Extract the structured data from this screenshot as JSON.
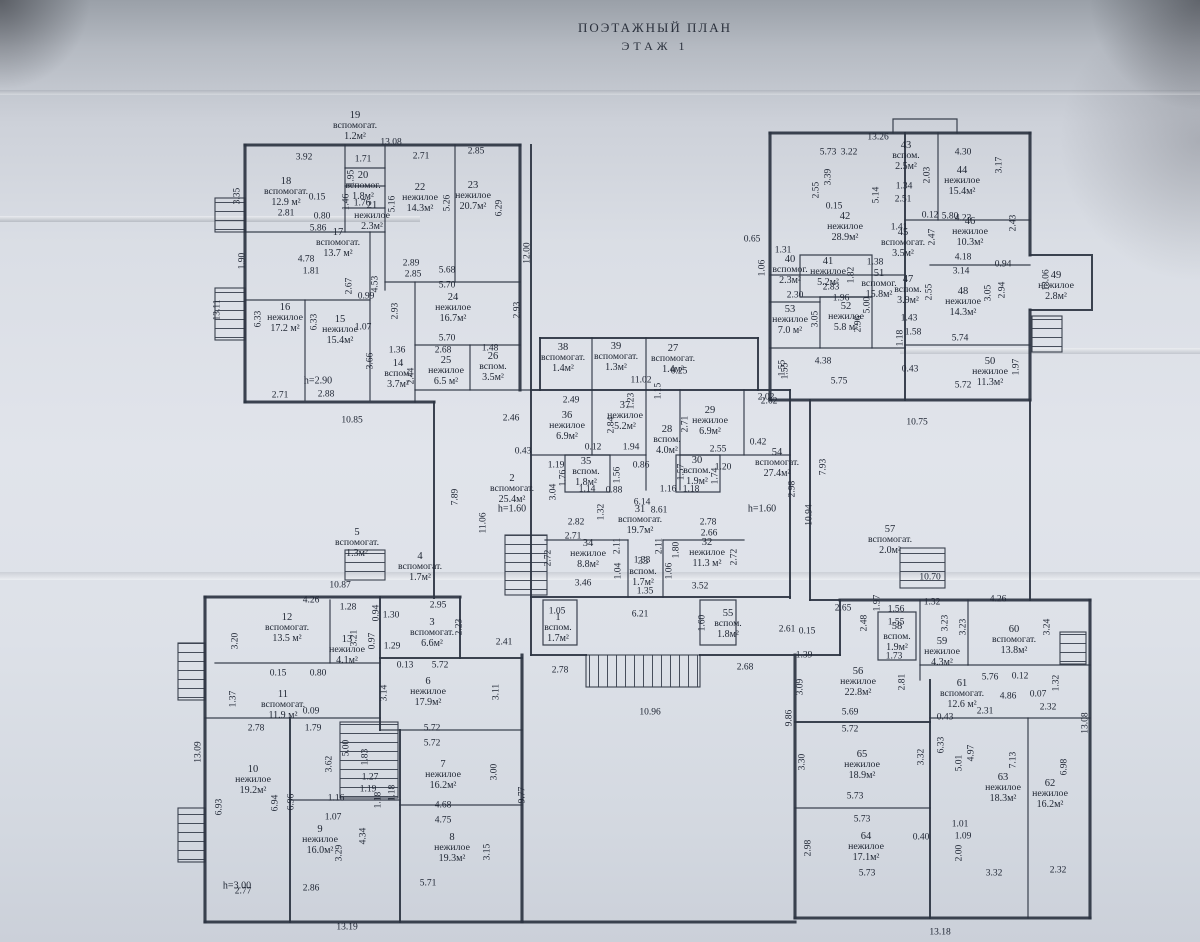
{
  "title": {
    "line1": "ПОЭТАЖНЫЙ ПЛАН",
    "line2": "ЭТАЖ   1"
  },
  "colors": {
    "ink": "#2d3442",
    "paper": "#dde1e8"
  },
  "rooms": [
    [
      "1",
      "вспом.",
      "1.7м²",
      558,
      628
    ],
    [
      "2",
      "вспомогат.",
      "25.4м²",
      512,
      489
    ],
    [
      "3",
      "вспомогат.",
      "6.6м²",
      432,
      633
    ],
    [
      "4",
      "вспомогат.",
      "1.7м²",
      420,
      567
    ],
    [
      "5",
      "вспомогат.",
      "1.3м²",
      357,
      543
    ],
    [
      "6",
      "нежилое",
      "17.9м²",
      428,
      692
    ],
    [
      "7",
      "нежилое",
      "16.2м²",
      443,
      775
    ],
    [
      "8",
      "нежилое",
      "19.3м²",
      452,
      848
    ],
    [
      "9",
      "нежилое",
      "16.0м²",
      320,
      840
    ],
    [
      "10",
      "нежилое",
      "19.2м²",
      253,
      780
    ],
    [
      "11",
      "вспомогат.",
      "11.9 м²",
      283,
      705
    ],
    [
      "12",
      "вспомогат.",
      "13.5 м²",
      287,
      628
    ],
    [
      "13",
      "нежилое",
      "4.1м²",
      347,
      650
    ],
    [
      "14",
      "вспом.",
      "3.7м²",
      398,
      374
    ],
    [
      "15",
      "нежилое",
      "15.4м²",
      340,
      330
    ],
    [
      "16",
      "нежилое",
      "17.2 м²",
      285,
      318
    ],
    [
      "17",
      "вспомогат.",
      "13.7 м²",
      338,
      243
    ],
    [
      "18",
      "вспомогат.",
      "12.9 м²",
      286,
      192
    ],
    [
      "19",
      "вспомогат.",
      "1.2м²",
      355,
      126
    ],
    [
      "20",
      "вспомог.",
      "1.8м²",
      363,
      186
    ],
    [
      "21",
      "нежилое",
      "2.3м²",
      372,
      216
    ],
    [
      "22",
      "нежилое",
      "14.3м²",
      420,
      198
    ],
    [
      "23",
      "нежилое",
      "20.7м²",
      473,
      196
    ],
    [
      "24",
      "нежилое",
      "16.7м²",
      453,
      308
    ],
    [
      "25",
      "нежилое",
      "6.5 м²",
      446,
      371
    ],
    [
      "26",
      "вспом.",
      "3.5м²",
      493,
      367
    ],
    [
      "27",
      "вспомогат.",
      "1.4м²",
      673,
      359
    ],
    [
      "28",
      "вспом.",
      "4.0м²",
      667,
      440
    ],
    [
      "29",
      "нежилое",
      "6.9м²",
      710,
      421
    ],
    [
      "30",
      "вспом.",
      "1.9м²",
      697,
      471
    ],
    [
      "31",
      "вспомогат.",
      "19.7м²",
      640,
      520
    ],
    [
      "32",
      "нежилое",
      "11.3 м²",
      707,
      553
    ],
    [
      "33",
      "вспом.",
      "1.7м²",
      643,
      572
    ],
    [
      "34",
      "нежилое",
      "8.8м²",
      588,
      554
    ],
    [
      "35",
      "вспом.",
      "1.8м²",
      586,
      472
    ],
    [
      "36",
      "нежилое",
      "6.9м²",
      567,
      426
    ],
    [
      "37",
      "нежилое",
      "5.2м²",
      625,
      416
    ],
    [
      "38",
      "вспомогат.",
      "1.4м²",
      563,
      358
    ],
    [
      "39",
      "вспомогат.",
      "1.3м²",
      616,
      357
    ],
    [
      "40",
      "вспомог.",
      "2.3м²",
      790,
      270
    ],
    [
      "41",
      "нежилое",
      "5.2м²",
      828,
      272
    ],
    [
      "42",
      "нежилое",
      "28.9м²",
      845,
      227
    ],
    [
      "43",
      "вспом.",
      "2.5м²",
      906,
      156
    ],
    [
      "44",
      "нежилое",
      "15.4м²",
      962,
      181
    ],
    [
      "45",
      "вспомогат.",
      "3.5м²",
      903,
      243
    ],
    [
      "46",
      "нежилое",
      "10.3м²",
      970,
      232
    ],
    [
      "47",
      "вспом.",
      "3.9м²",
      908,
      290
    ],
    [
      "48",
      "нежилое",
      "14.3м²",
      963,
      302
    ],
    [
      "49",
      "нежилое",
      "2.8м²",
      1056,
      286
    ],
    [
      "50",
      "нежилое",
      "11.3м²",
      990,
      372
    ],
    [
      "51",
      "вспомог.",
      "15.8м²",
      879,
      284
    ],
    [
      "52",
      "нежилое",
      "5.8 м²",
      846,
      317
    ],
    [
      "53",
      "нежилое",
      "7.0 м²",
      790,
      320
    ],
    [
      "54",
      "вспомогат.",
      "27.4м²",
      777,
      463
    ],
    [
      "55",
      "вспом.",
      "1.8м²",
      728,
      624
    ],
    [
      "56",
      "нежилое",
      "22.8м²",
      858,
      682
    ],
    [
      "57",
      "вспомогат.",
      "2.0м²",
      890,
      540
    ],
    [
      "58",
      "вспом.",
      "1.9м²",
      897,
      637
    ],
    [
      "59",
      "нежилое",
      "4.3м²",
      942,
      652
    ],
    [
      "60",
      "вспомогат.",
      "13.8м²",
      1014,
      640
    ],
    [
      "61",
      "вспомогат.",
      "12.6 м²",
      962,
      694
    ],
    [
      "62",
      "нежилое",
      "16.2м²",
      1050,
      794
    ],
    [
      "63",
      "нежилое",
      "18.3м²",
      1003,
      788
    ],
    [
      "64",
      "нежилое",
      "17.1м²",
      866,
      847
    ],
    [
      "65",
      "нежилое",
      "18.9м²",
      862,
      765
    ]
  ],
  "dims": [
    [
      "13.08",
      391,
      143,
      0
    ],
    [
      "3.92",
      304,
      158,
      0
    ],
    [
      "1.71",
      363,
      160,
      0
    ],
    [
      "2.71",
      421,
      157,
      0
    ],
    [
      "2.85",
      476,
      152,
      0
    ],
    [
      "1.95",
      352,
      178,
      1
    ],
    [
      "3.35",
      238,
      196,
      1
    ],
    [
      "0.15",
      317,
      198,
      0
    ],
    [
      "1.46",
      347,
      202,
      1
    ],
    [
      "1.76",
      362,
      204,
      0
    ],
    [
      "2.81",
      286,
      214,
      0
    ],
    [
      "0.80",
      322,
      217,
      0
    ],
    [
      "5.86",
      318,
      229,
      0
    ],
    [
      "5.16",
      393,
      204,
      1
    ],
    [
      "5.26",
      448,
      203,
      1
    ],
    [
      "6.29",
      500,
      208,
      1
    ],
    [
      "1.90",
      243,
      261,
      1
    ],
    [
      "4.78",
      306,
      260,
      0
    ],
    [
      "1.81",
      311,
      272,
      0
    ],
    [
      "2.89",
      411,
      264,
      0
    ],
    [
      "2.85",
      413,
      275,
      0
    ],
    [
      "5.68",
      447,
      271,
      0
    ],
    [
      "5.70",
      447,
      286,
      0
    ],
    [
      "4.53",
      376,
      284,
      1
    ],
    [
      "2.67",
      350,
      286,
      1
    ],
    [
      "0.99",
      366,
      297,
      0
    ],
    [
      "2.93",
      396,
      311,
      1
    ],
    [
      "2.93",
      518,
      310,
      1
    ],
    [
      "12.00",
      528,
      253,
      1
    ],
    [
      "13.11",
      218,
      310,
      1
    ],
    [
      "6.33",
      259,
      319,
      1
    ],
    [
      "6.33",
      315,
      322,
      1
    ],
    [
      "1.07",
      363,
      328,
      0
    ],
    [
      "5.70",
      447,
      339,
      0
    ],
    [
      "2.68",
      443,
      351,
      0
    ],
    [
      "1.48",
      490,
      349,
      0
    ],
    [
      "1.36",
      397,
      351,
      0
    ],
    [
      "3.66",
      371,
      361,
      1
    ],
    [
      "2.44",
      412,
      376,
      1
    ],
    [
      "2.71",
      280,
      396,
      0
    ],
    [
      "2.88",
      326,
      395,
      0
    ],
    [
      "10.85",
      352,
      421,
      0
    ],
    [
      "2.46",
      511,
      419,
      0
    ],
    [
      "0.43",
      523,
      452,
      0
    ],
    [
      "7.89",
      456,
      497,
      1
    ],
    [
      "11.06",
      484,
      523,
      1
    ],
    [
      "10.87",
      340,
      586,
      0
    ],
    [
      "11.02",
      641,
      381,
      0
    ],
    [
      "0.25",
      679,
      372,
      0
    ],
    [
      "1.15",
      659,
      391,
      1
    ],
    [
      "1.23",
      632,
      401,
      1
    ],
    [
      "1.55",
      783,
      368,
      1
    ],
    [
      "2.62",
      769,
      402,
      0
    ],
    [
      "2.49",
      571,
      401,
      0
    ],
    [
      "2.84",
      612,
      425,
      1
    ],
    [
      "2.71",
      686,
      424,
      1
    ],
    [
      "0.12",
      593,
      448,
      0
    ],
    [
      "1.94",
      631,
      448,
      0
    ],
    [
      "2.55",
      718,
      450,
      0
    ],
    [
      "0.42",
      758,
      443,
      0
    ],
    [
      "1.19",
      556,
      466,
      0
    ],
    [
      "1.76",
      564,
      478,
      1
    ],
    [
      "1.14",
      587,
      490,
      0
    ],
    [
      "0.88",
      614,
      491,
      0
    ],
    [
      "0.86",
      641,
      466,
      0
    ],
    [
      "1.56",
      618,
      475,
      1
    ],
    [
      "1.57",
      682,
      472,
      1
    ],
    [
      "1.16",
      668,
      490,
      0
    ],
    [
      "1.18",
      691,
      490,
      0
    ],
    [
      "1.20",
      723,
      468,
      0
    ],
    [
      "1.74",
      716,
      476,
      1
    ],
    [
      "2.98",
      793,
      489,
      1
    ],
    [
      "3.04",
      554,
      492,
      1
    ],
    [
      "1.32",
      602,
      512,
      1
    ],
    [
      "6.14",
      642,
      503,
      0
    ],
    [
      "8.61",
      659,
      511,
      0
    ],
    [
      "2.82",
      576,
      523,
      0
    ],
    [
      "2.71",
      573,
      537,
      0
    ],
    [
      "2.78",
      708,
      523,
      0
    ],
    [
      "2.66",
      709,
      534,
      0
    ],
    [
      "2.72",
      549,
      558,
      1
    ],
    [
      "2.11",
      618,
      546,
      1
    ],
    [
      "2.11",
      660,
      546,
      1
    ],
    [
      "1.80",
      677,
      550,
      1
    ],
    [
      "2.72",
      735,
      557,
      1
    ],
    [
      "1.33",
      642,
      561,
      0
    ],
    [
      "1.04",
      619,
      571,
      1
    ],
    [
      "1.06",
      670,
      571,
      1
    ],
    [
      "3.46",
      583,
      584,
      0
    ],
    [
      "3.52",
      700,
      587,
      0
    ],
    [
      "1.35",
      645,
      592,
      0
    ],
    [
      "6.21",
      640,
      615,
      0
    ],
    [
      "1.05",
      557,
      612,
      0
    ],
    [
      "1.60",
      703,
      623,
      1
    ],
    [
      "2.61",
      787,
      630,
      0
    ],
    [
      "0.15",
      807,
      632,
      0
    ],
    [
      "1.39",
      804,
      656,
      0
    ],
    [
      "2.78",
      560,
      671,
      0
    ],
    [
      "2.68",
      745,
      668,
      0
    ],
    [
      "10.96",
      650,
      713,
      0
    ],
    [
      "3.09",
      801,
      687,
      1
    ],
    [
      "9.86",
      790,
      718,
      1
    ],
    [
      "13.26",
      878,
      138,
      0
    ],
    [
      "5.73",
      828,
      153,
      0
    ],
    [
      "3.22",
      849,
      153,
      0
    ],
    [
      "3.39",
      829,
      177,
      1
    ],
    [
      "2.55",
      817,
      190,
      1
    ],
    [
      "5.14",
      877,
      195,
      1
    ],
    [
      "4.30",
      963,
      153,
      0
    ],
    [
      "2.03",
      928,
      175,
      1
    ],
    [
      "1.34",
      904,
      187,
      0
    ],
    [
      "2.51",
      903,
      200,
      0
    ],
    [
      "0.15",
      834,
      207,
      0
    ],
    [
      "0.12",
      930,
      216,
      0
    ],
    [
      "5.80",
      950,
      217,
      0
    ],
    [
      "3.17",
      1000,
      165,
      1
    ],
    [
      "4.23",
      963,
      219,
      0
    ],
    [
      "2.43",
      1014,
      223,
      1
    ],
    [
      "1.41",
      899,
      228,
      0
    ],
    [
      "2.47",
      933,
      237,
      1
    ],
    [
      "0.65",
      752,
      240,
      0
    ],
    [
      "1.31",
      783,
      251,
      0
    ],
    [
      "1.06",
      763,
      268,
      1
    ],
    [
      "4.18",
      963,
      258,
      0
    ],
    [
      "3.14",
      961,
      272,
      0
    ],
    [
      "0.94",
      1003,
      265,
      0
    ],
    [
      "2.94",
      1003,
      290,
      1
    ],
    [
      "3.05",
      989,
      293,
      1
    ],
    [
      "13.06",
      1047,
      280,
      1
    ],
    [
      "1.38",
      875,
      263,
      0
    ],
    [
      "1.82",
      852,
      275,
      1
    ],
    [
      "2.83",
      831,
      288,
      0
    ],
    [
      "2.30",
      795,
      296,
      0
    ],
    [
      "1.96",
      841,
      299,
      0
    ],
    [
      "3.05",
      816,
      319,
      1
    ],
    [
      "5.00",
      868,
      305,
      1
    ],
    [
      "2.96",
      859,
      324,
      1
    ],
    [
      "1.43",
      909,
      319,
      0
    ],
    [
      "1.58",
      913,
      333,
      0
    ],
    [
      "2.55",
      930,
      292,
      1
    ],
    [
      "1.18",
      901,
      338,
      1
    ],
    [
      "0.43",
      910,
      370,
      0
    ],
    [
      "5.74",
      960,
      339,
      0
    ],
    [
      "5.72",
      963,
      386,
      0
    ],
    [
      "1.97",
      1017,
      367,
      1
    ],
    [
      "4.38",
      823,
      362,
      0
    ],
    [
      "5.75",
      839,
      382,
      0
    ],
    [
      "1.55",
      786,
      371,
      1
    ],
    [
      "2.02",
      766,
      398,
      0
    ],
    [
      "7.93",
      824,
      467,
      1
    ],
    [
      "10.94",
      810,
      515,
      1
    ],
    [
      "10.75",
      917,
      423,
      0
    ],
    [
      "10.70",
      930,
      578,
      0
    ],
    [
      "4.26",
      311,
      601,
      0
    ],
    [
      "1.28",
      348,
      608,
      0
    ],
    [
      "0.94",
      377,
      613,
      1
    ],
    [
      "1.30",
      391,
      616,
      0
    ],
    [
      "3.20",
      236,
      641,
      1
    ],
    [
      "3.21",
      355,
      638,
      1
    ],
    [
      "0.97",
      373,
      641,
      1
    ],
    [
      "1.29",
      392,
      647,
      0
    ],
    [
      "2.95",
      438,
      606,
      0
    ],
    [
      "2.23",
      460,
      627,
      1
    ],
    [
      "2.41",
      504,
      643,
      0
    ],
    [
      "0.13",
      405,
      666,
      0
    ],
    [
      "5.72",
      440,
      666,
      0
    ],
    [
      "0.15",
      278,
      674,
      0
    ],
    [
      "0.80",
      318,
      674,
      0
    ],
    [
      "1.37",
      234,
      699,
      1
    ],
    [
      "0.09",
      311,
      712,
      0
    ],
    [
      "2.78",
      256,
      729,
      0
    ],
    [
      "1.79",
      313,
      729,
      0
    ],
    [
      "3.14",
      385,
      693,
      1
    ],
    [
      "3.11",
      497,
      692,
      1
    ],
    [
      "13.09",
      199,
      752,
      1
    ],
    [
      "3.62",
      330,
      764,
      1
    ],
    [
      "5.00",
      347,
      748,
      1
    ],
    [
      "1.83",
      366,
      757,
      1
    ],
    [
      "1.27",
      370,
      778,
      0
    ],
    [
      "1.19",
      368,
      790,
      0
    ],
    [
      "1.18",
      379,
      800,
      1
    ],
    [
      "1.18",
      393,
      793,
      1
    ],
    [
      "1.16",
      336,
      799,
      0
    ],
    [
      "1.07",
      333,
      818,
      0
    ],
    [
      "4.34",
      364,
      836,
      1
    ],
    [
      "3.29",
      340,
      853,
      1
    ],
    [
      "6.93",
      220,
      807,
      1
    ],
    [
      "6.94",
      276,
      803,
      1
    ],
    [
      "6.96",
      292,
      802,
      1
    ],
    [
      "2.77",
      243,
      892,
      0
    ],
    [
      "2.86",
      311,
      889,
      0
    ],
    [
      "13.19",
      347,
      928,
      0
    ],
    [
      "5.71",
      428,
      884,
      0
    ],
    [
      "3.15",
      488,
      852,
      1
    ],
    [
      "4.75",
      443,
      821,
      0
    ],
    [
      "4.68",
      443,
      806,
      0
    ],
    [
      "3.00",
      495,
      772,
      1
    ],
    [
      "9.77",
      523,
      795,
      1
    ],
    [
      "5.72",
      432,
      729,
      0
    ],
    [
      "5.72",
      432,
      744,
      0
    ],
    [
      "2.65",
      843,
      609,
      0
    ],
    [
      "2.48",
      865,
      623,
      1
    ],
    [
      "1.97",
      878,
      603,
      1
    ],
    [
      "1.56",
      896,
      610,
      0
    ],
    [
      "1.55",
      896,
      623,
      0
    ],
    [
      "1.73",
      894,
      657,
      0
    ],
    [
      "1.32",
      932,
      603,
      0
    ],
    [
      "3.23",
      946,
      623,
      1
    ],
    [
      "3.23",
      964,
      627,
      1
    ],
    [
      "4.26",
      998,
      600,
      0
    ],
    [
      "3.24",
      1048,
      627,
      1
    ],
    [
      "5.76",
      990,
      678,
      0
    ],
    [
      "0.12",
      1020,
      677,
      0
    ],
    [
      "1.32",
      1057,
      683,
      1
    ],
    [
      "2.81",
      903,
      682,
      1
    ],
    [
      "0.43",
      945,
      718,
      0
    ],
    [
      "2.31",
      985,
      712,
      0
    ],
    [
      "4.86",
      1008,
      697,
      0
    ],
    [
      "0.07",
      1038,
      695,
      0
    ],
    [
      "2.32",
      1048,
      708,
      0
    ],
    [
      "5.69",
      850,
      713,
      0
    ],
    [
      "5.72",
      850,
      730,
      0
    ],
    [
      "13.08",
      1086,
      723,
      1
    ],
    [
      "3.30",
      803,
      762,
      1
    ],
    [
      "3.32",
      922,
      757,
      1
    ],
    [
      "6.33",
      942,
      745,
      1
    ],
    [
      "5.01",
      960,
      763,
      1
    ],
    [
      "4.97",
      972,
      753,
      1
    ],
    [
      "7.13",
      1014,
      760,
      1
    ],
    [
      "6.98",
      1065,
      767,
      1
    ],
    [
      "5.73",
      855,
      797,
      0
    ],
    [
      "5.73",
      862,
      820,
      0
    ],
    [
      "2.98",
      809,
      848,
      1
    ],
    [
      "0.40",
      921,
      838,
      0
    ],
    [
      "1.01",
      960,
      825,
      0
    ],
    [
      "1.09",
      963,
      837,
      0
    ],
    [
      "2.00",
      960,
      853,
      1
    ],
    [
      "5.73",
      867,
      874,
      0
    ],
    [
      "3.32",
      994,
      874,
      0
    ],
    [
      "2.32",
      1058,
      871,
      0
    ],
    [
      "13.18",
      940,
      933,
      0
    ]
  ],
  "notes": [
    [
      "h=2.90",
      318,
      381
    ],
    [
      "h=1.60",
      512,
      509
    ],
    [
      "h=1.60",
      762,
      509
    ],
    [
      "h=3.00",
      237,
      886
    ]
  ]
}
